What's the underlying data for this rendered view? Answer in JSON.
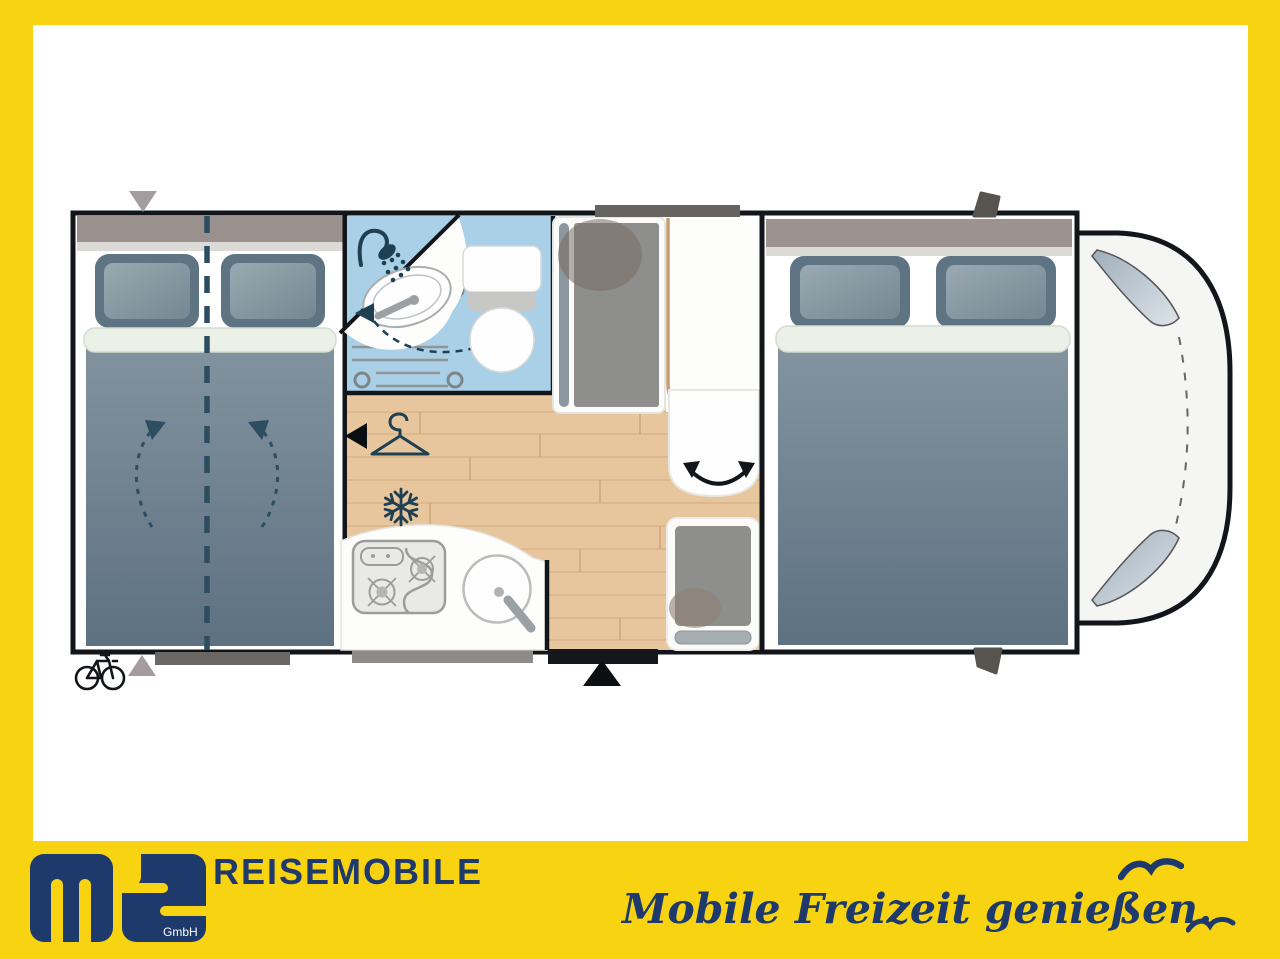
{
  "branding": {
    "logo_letters": "ms",
    "logo_sub": "GmbH",
    "company": "REISEMOBILE",
    "slogan": "Mobile Freizeit genießen."
  },
  "colors": {
    "frame_yellow": "#F8D311",
    "brand_navy": "#1E3A6D",
    "wall_black": "#121519",
    "bathroom_blue": "#A9D0E6",
    "wood_floor": "#E8C69D",
    "bed_fabric": "#6E8190",
    "pillow_edge": "#5E7482",
    "headboard_gray": "#9A908E",
    "marker_gray": "#A59CA0",
    "dark_marker": "#57534E",
    "icon_teal": "#1E4052"
  },
  "floorplan": {
    "view": "motorhome top view",
    "areas": [
      "rear-double-bed",
      "bathroom-with-shower-basin-toilet",
      "wardrobe",
      "tall-fridge-cabinet",
      "dinette-bench",
      "swivel-seat",
      "rear-travel-seat",
      "kitchen-with-hob-and-sink",
      "front-double-bed",
      "driver-cab"
    ],
    "icons": [
      "shower-icon",
      "clothes-hanger-icon",
      "snowflake-icon",
      "bicycle-icon",
      "swivel-arrows-icon",
      "entry-door-arrow-icon",
      "bed-split-arrows-icon",
      "seagull-icon"
    ]
  }
}
